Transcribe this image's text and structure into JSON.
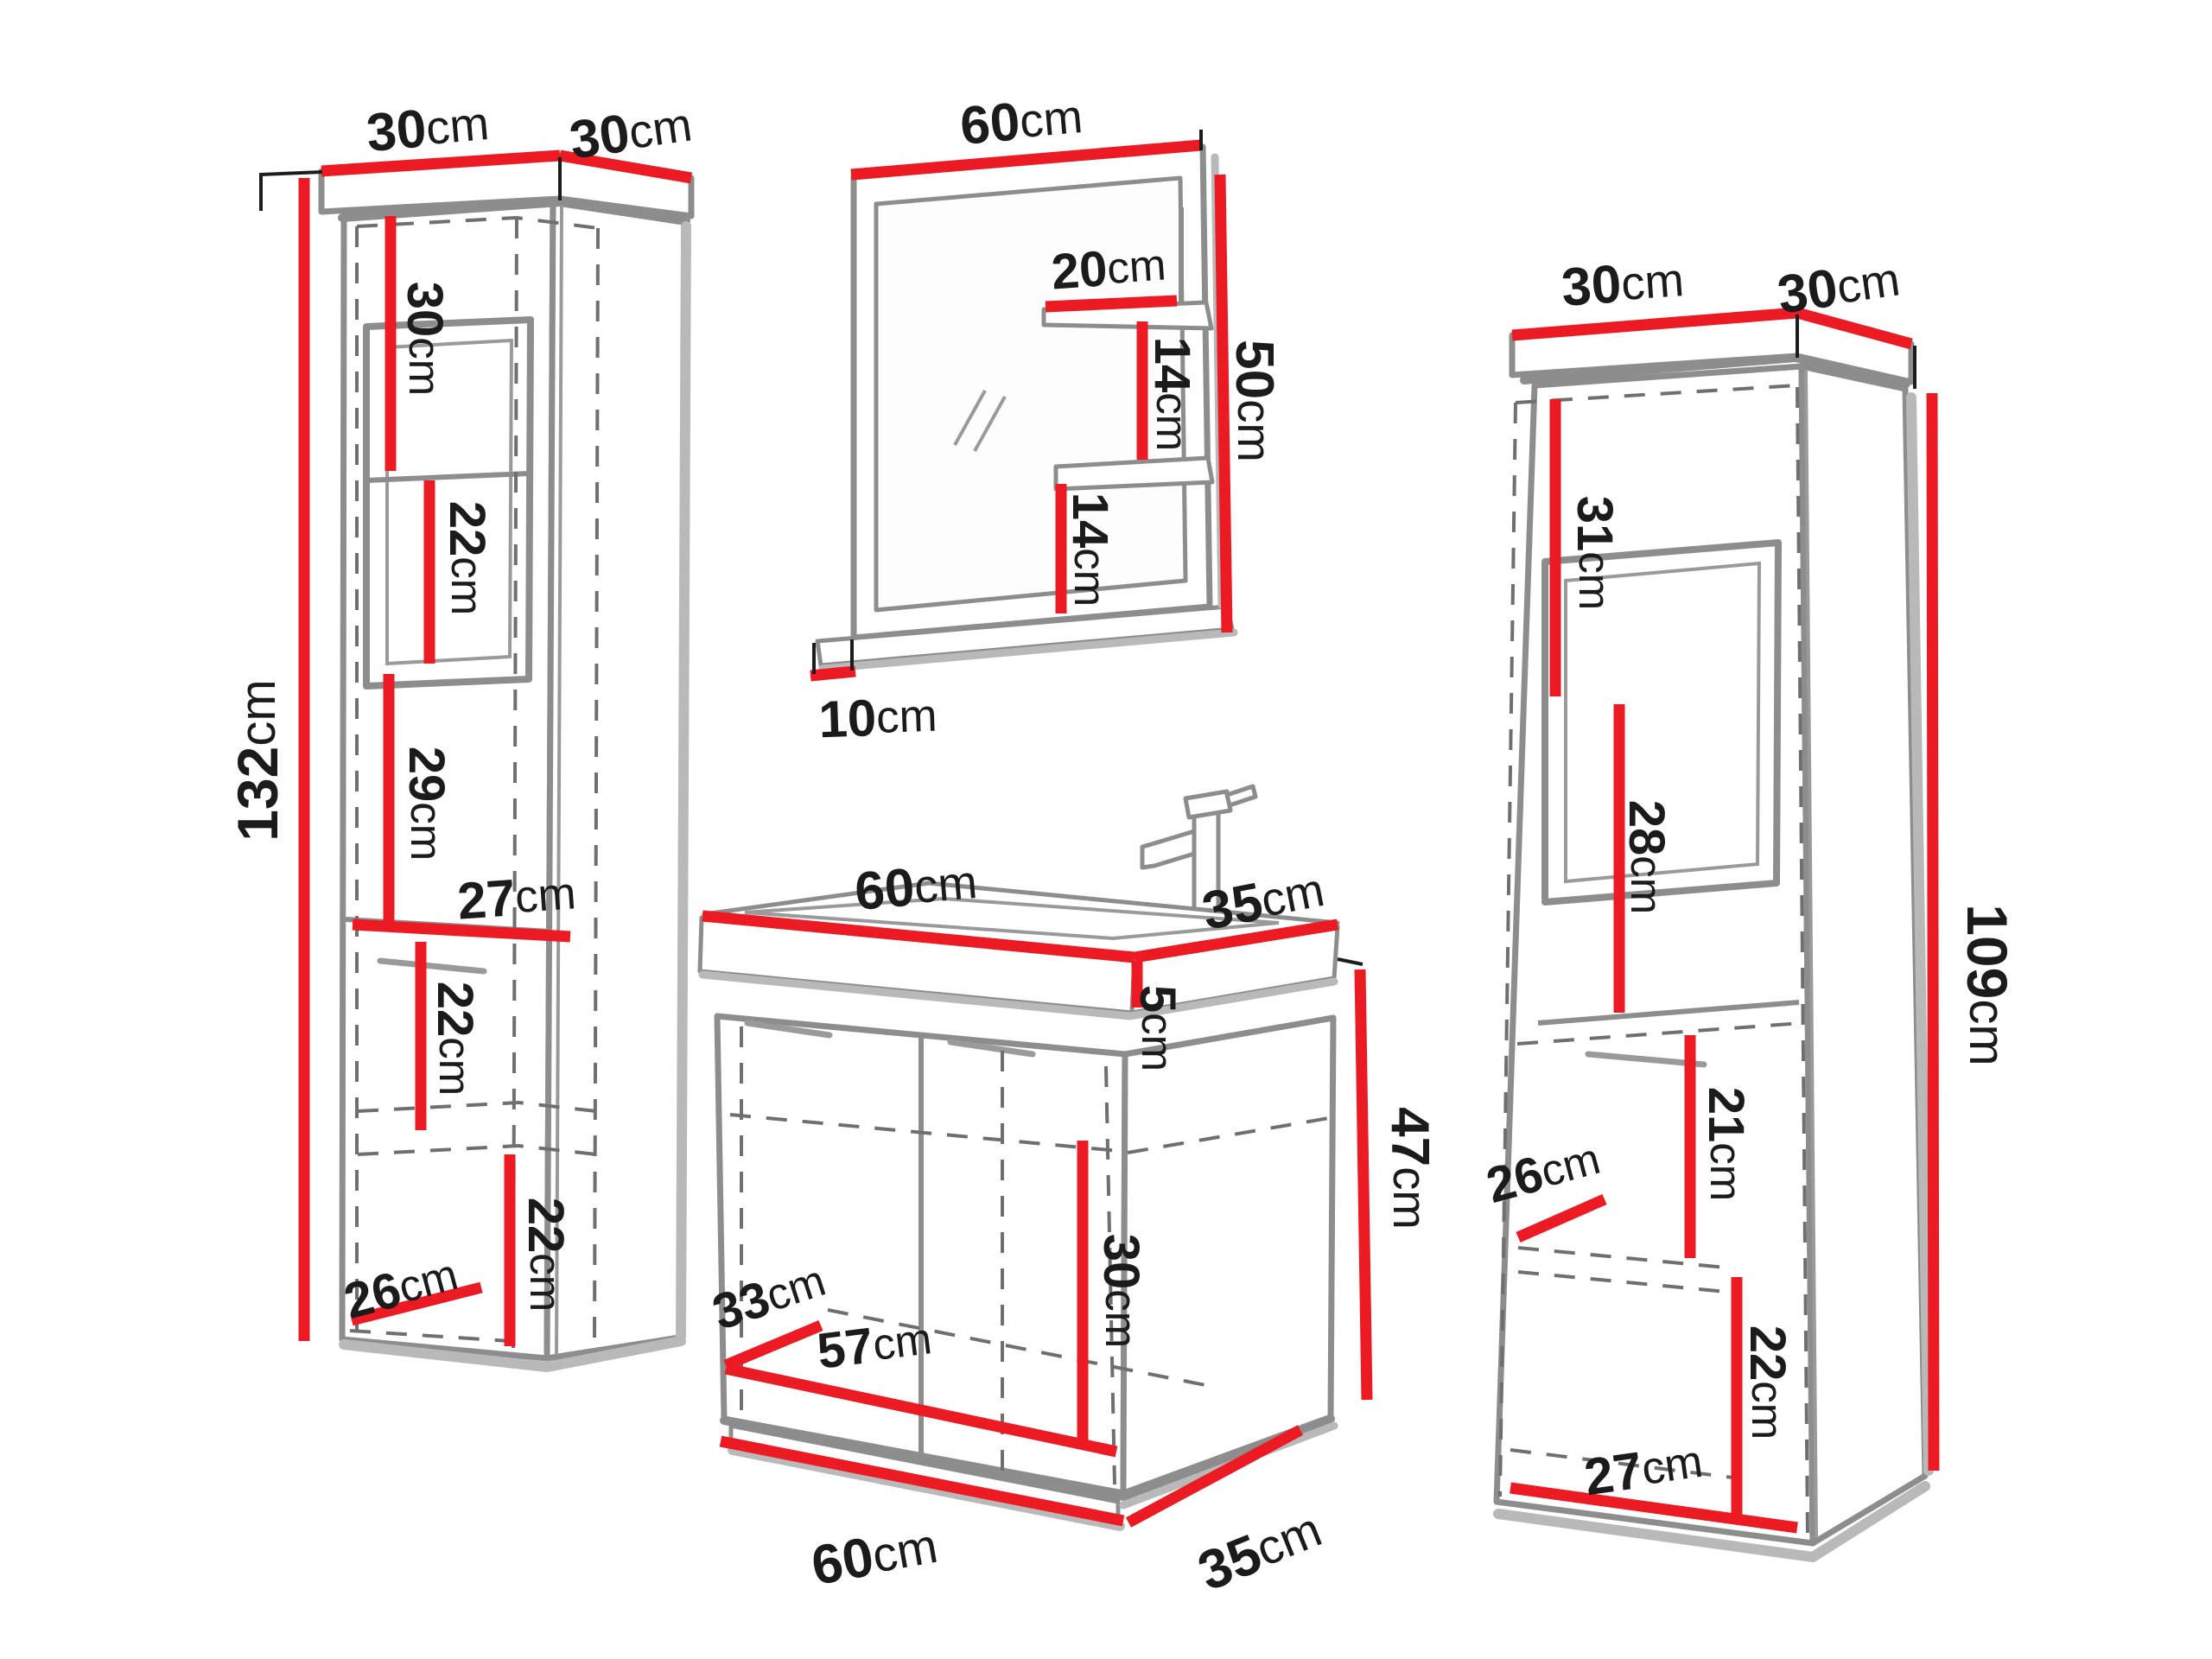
{
  "diagram": {
    "type": "furniture-dimension-diagram",
    "subject": "bathroom furniture set: two tall column cabinets, mirror with shelves, washbasin vanity cabinet",
    "unit": "cm",
    "colors": {
      "dimension_line": "#ec1b23",
      "cabinet_outline": "#8d8d8d",
      "label_text": "#1b1b1b",
      "background": "#ffffff"
    }
  },
  "pieces": {
    "left_column_cabinet": {
      "top_width": "30cm",
      "top_depth": "30cm",
      "height": "132cm",
      "internal_sections": [
        "30cm",
        "22cm",
        "29cm",
        "27cm",
        "22cm",
        "26cm",
        "22cm"
      ]
    },
    "mirror_with_shelves": {
      "width": "60cm",
      "height": "50cm",
      "shelf_width": "20cm",
      "shelf_gaps": [
        "14cm",
        "14cm"
      ],
      "ledge_depth": "10cm"
    },
    "washbasin_cabinet": {
      "top_width": "60cm",
      "top_depth": "35cm",
      "basin_height": "5cm",
      "body_height": "47cm",
      "internal_height": "30cm",
      "internal_depth": "33cm",
      "internal_width": "57cm",
      "base_width": "60cm",
      "base_depth": "35cm"
    },
    "right_column_cabinet": {
      "top_width": "30cm",
      "top_depth": "30cm",
      "height": "109cm",
      "internal_sections": [
        "31cm",
        "28cm",
        "21cm",
        "26cm",
        "22cm",
        "27cm"
      ]
    }
  },
  "labels": {
    "lc_top_w": {
      "v": "30",
      "u": "cm"
    },
    "lc_top_d": {
      "v": "30",
      "u": "cm"
    },
    "lc_height": {
      "v": "132",
      "u": "cm"
    },
    "lc_s1": {
      "v": "30",
      "u": "cm"
    },
    "lc_s2": {
      "v": "22",
      "u": "cm"
    },
    "lc_s3": {
      "v": "29",
      "u": "cm"
    },
    "lc_s4": {
      "v": "27",
      "u": "cm"
    },
    "lc_s5": {
      "v": "22",
      "u": "cm"
    },
    "lc_s6": {
      "v": "26",
      "u": "cm"
    },
    "lc_s7": {
      "v": "22",
      "u": "cm"
    },
    "mr_w": {
      "v": "60",
      "u": "cm"
    },
    "mr_shelf_w": {
      "v": "20",
      "u": "cm"
    },
    "mr_g1": {
      "v": "14",
      "u": "cm"
    },
    "mr_g2": {
      "v": "14",
      "u": "cm"
    },
    "mr_h": {
      "v": "50",
      "u": "cm"
    },
    "mr_d": {
      "v": "10",
      "u": "cm"
    },
    "sk_top_w": {
      "v": "60",
      "u": "cm"
    },
    "sk_top_d": {
      "v": "35",
      "u": "cm"
    },
    "sk_basin_h": {
      "v": "5",
      "u": "cm"
    },
    "sk_inner_h": {
      "v": "30",
      "u": "cm"
    },
    "sk_inner_d": {
      "v": "33",
      "u": "cm"
    },
    "sk_inner_w": {
      "v": "57",
      "u": "cm"
    },
    "sk_bot_w": {
      "v": "60",
      "u": "cm"
    },
    "sk_bot_d": {
      "v": "35",
      "u": "cm"
    },
    "sk_body_h": {
      "v": "47",
      "u": "cm"
    },
    "rc_top_w": {
      "v": "30",
      "u": "cm"
    },
    "rc_top_d": {
      "v": "30",
      "u": "cm"
    },
    "rc_s1": {
      "v": "31",
      "u": "cm"
    },
    "rc_s2": {
      "v": "28",
      "u": "cm"
    },
    "rc_s3": {
      "v": "21",
      "u": "cm"
    },
    "rc_s4": {
      "v": "26",
      "u": "cm"
    },
    "rc_s5": {
      "v": "22",
      "u": "cm"
    },
    "rc_s6": {
      "v": "27",
      "u": "cm"
    },
    "rc_height": {
      "v": "109",
      "u": "cm"
    }
  }
}
